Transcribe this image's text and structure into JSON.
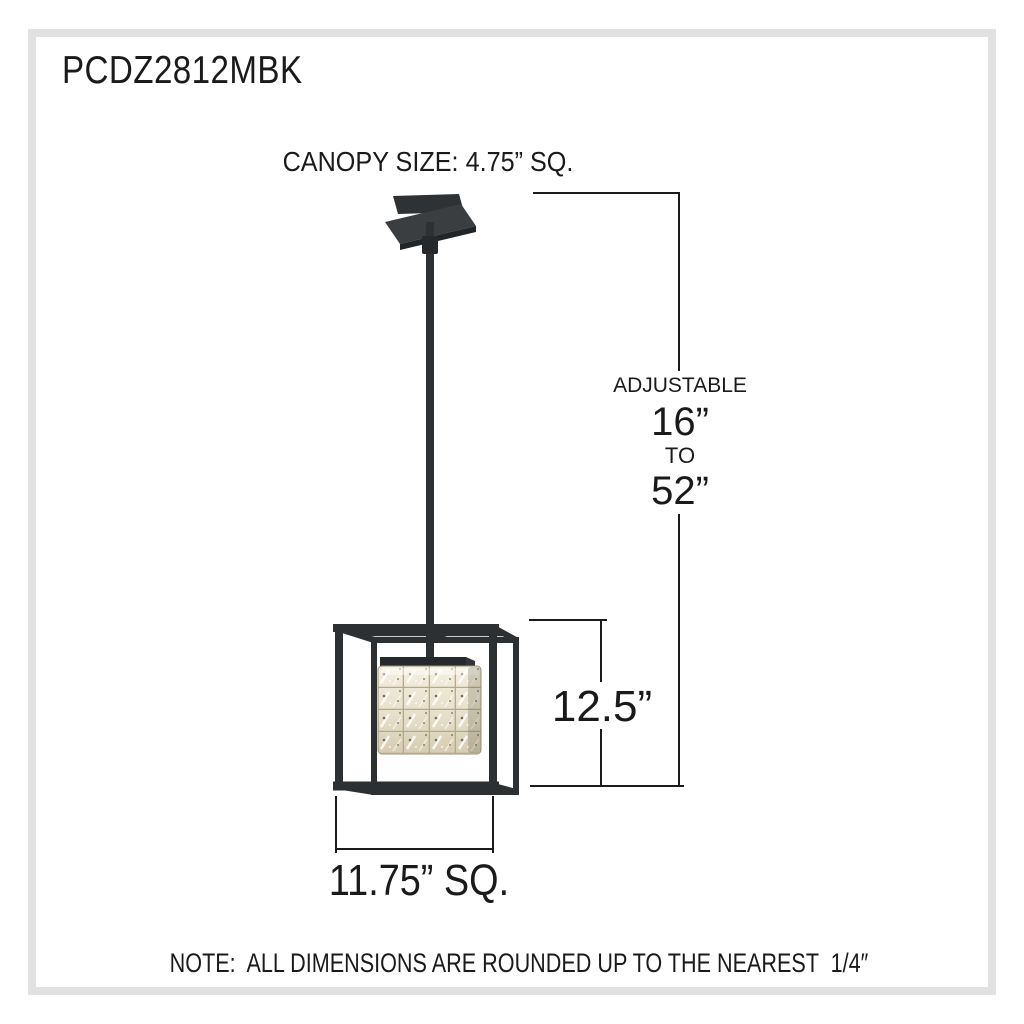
{
  "title": "PCDZ2812MBK",
  "canopy_label": "CANOPY SIZE: 4.75” SQ.",
  "adjustable": {
    "label": "ADJUSTABLE",
    "min": "16”",
    "to": "TO",
    "max": "52”"
  },
  "height_label": "12.5”",
  "width_label": "11.75” SQ.",
  "note": "NOTE:  ALL DIMENSIONS ARE ROUNDED UP TO THE NEAREST  1/4″",
  "colors": {
    "background": "#ffffff",
    "page_border": "#e1e1e1",
    "dimension_line": "#1b1b1b",
    "text": "#1a1a1a",
    "fixture_metal": "#2c3032",
    "crystal_light": "#f2ecdb",
    "crystal_dark": "#d8cfb7"
  }
}
